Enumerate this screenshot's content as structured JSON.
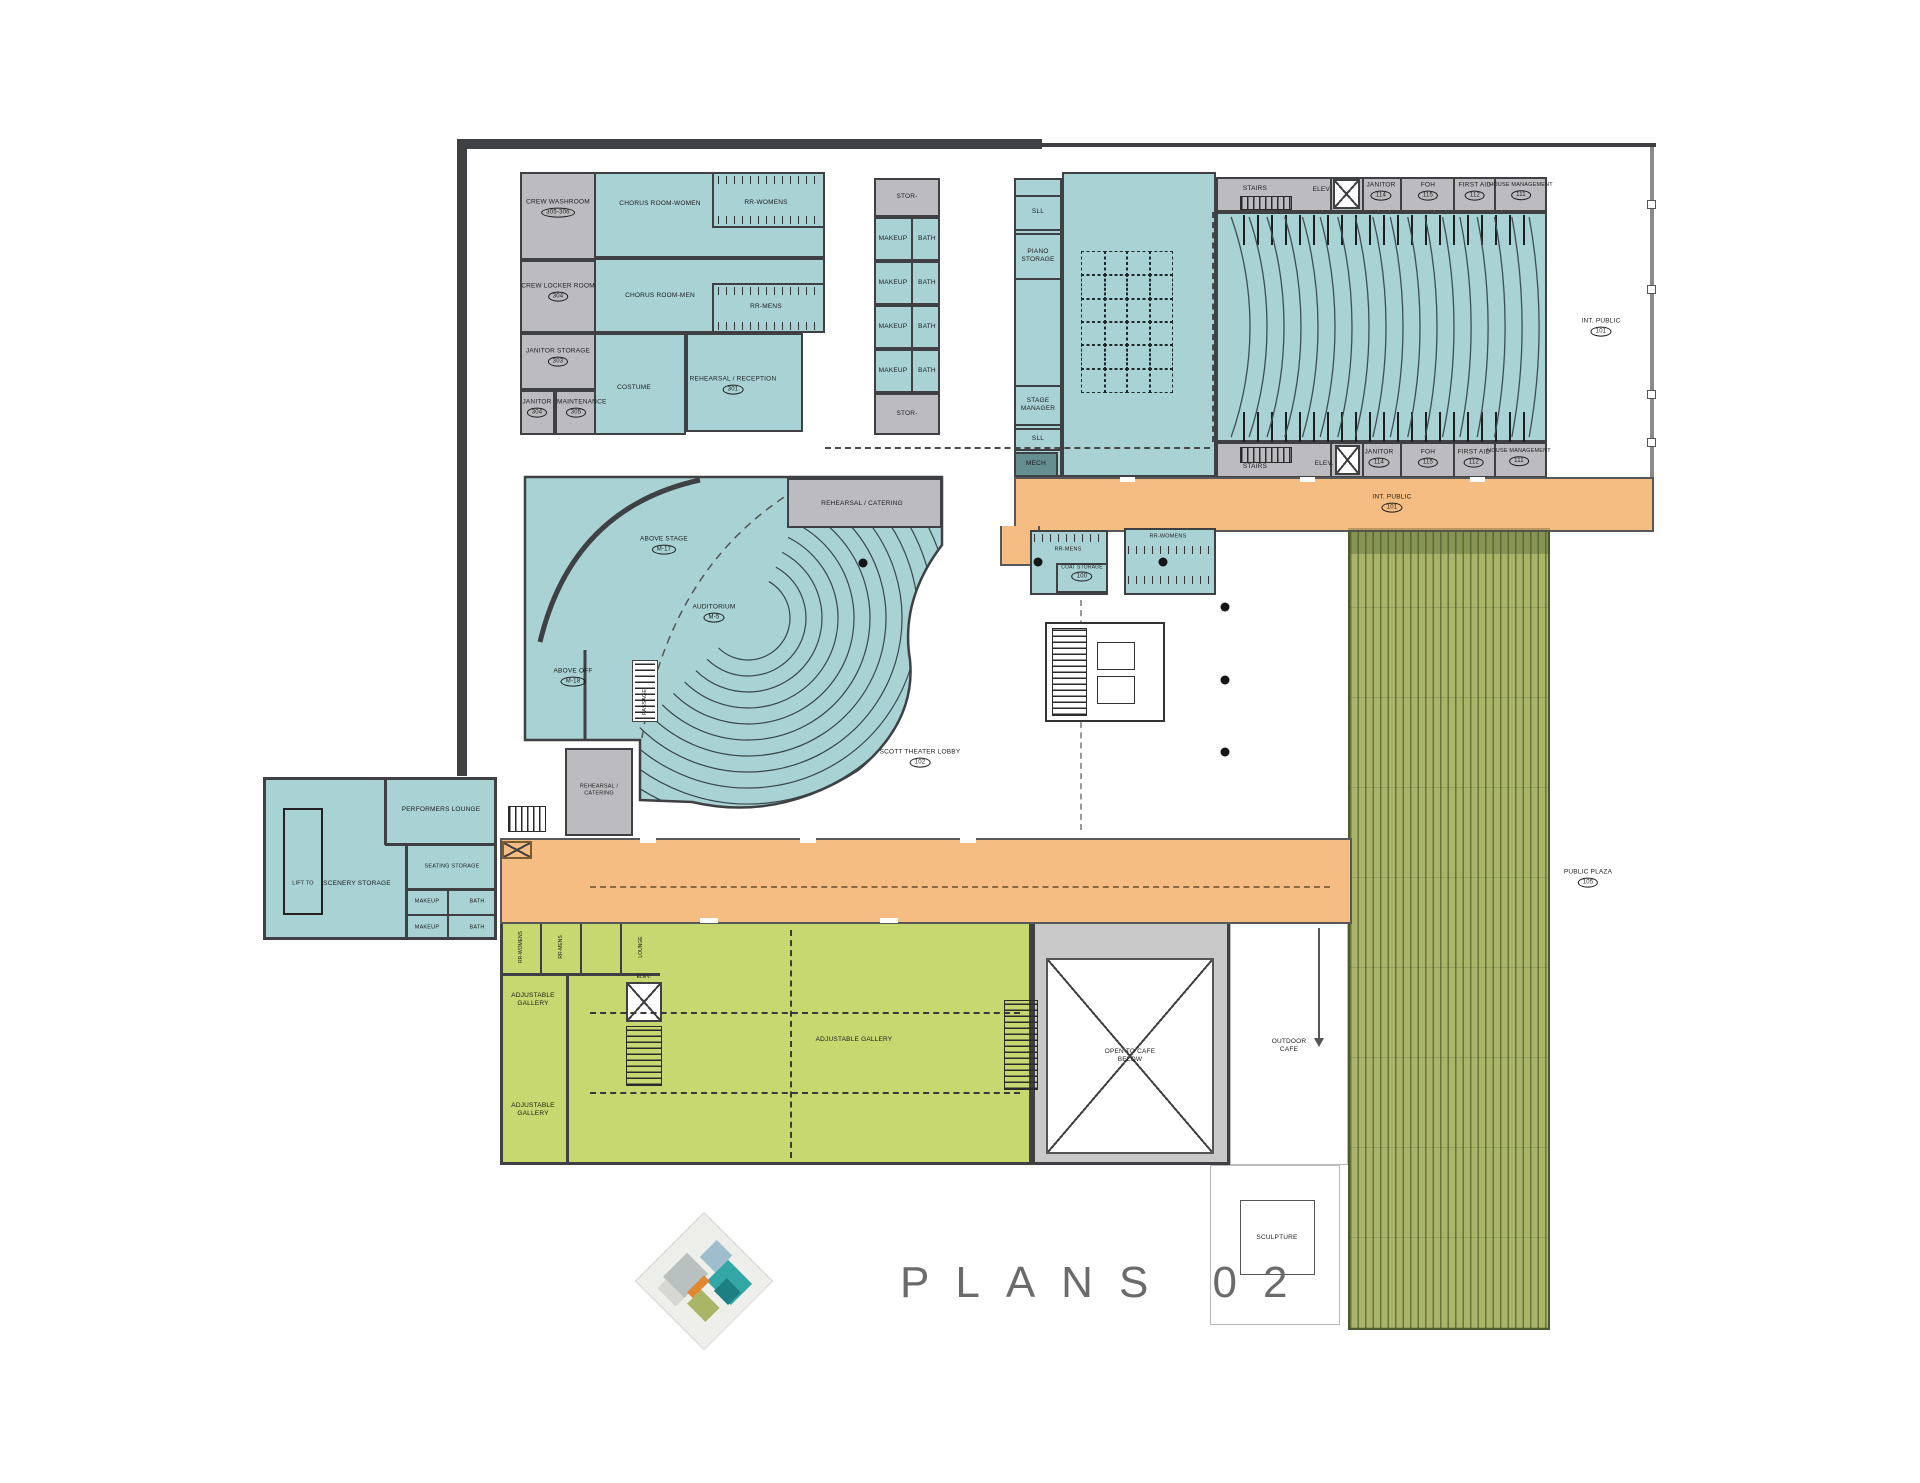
{
  "title": "PLANS 02",
  "colors": {
    "room_teal": "#a9d2d4",
    "room_gray": "#bcbcc0",
    "wall": "#3f4043",
    "terrace_orange": "#f6bd82",
    "gallery_green": "#c6d86f",
    "plaza_olive": "#abb56a"
  },
  "r": {
    "crew_washroom": "CREW WASHROOM",
    "crew_washroom_no": "305-306",
    "crew_locker": "CREW LOCKER ROOM",
    "crew_locker_no": "304",
    "janitor_storage": "JANITOR STORAGE",
    "janitor_storage_no": "303",
    "janitor": "JANITOR",
    "janitor_no": "304",
    "maintenance": "MAINTENANCE",
    "maintenance_no": "305",
    "chorus_women": "CHORUS ROOM-WOMEN",
    "rr_womens": "RR-WOMENS",
    "chorus_men": "CHORUS ROOM-MEN",
    "rr_mens": "RR-MENS",
    "costume": "COSTUME",
    "rehearsal_reception": "REHEARSAL / RECEPTION",
    "rehearsal_reception_no": "301",
    "stor": "STOR-",
    "makeup": "MAKEUP",
    "bath": "BATH",
    "sll": "SLL",
    "piano": "PIANO STORAGE",
    "stage_manager": "STAGE MANAGER",
    "mech": "MECH",
    "stairs": "STAIRS",
    "elev": "ELEV.",
    "janitor_th": "JANITOR",
    "janitor_th_no": "114",
    "foh": "FOH",
    "foh_no": "115",
    "first_aid": "FIRST AID",
    "first_aid_no": "112",
    "house_mgmt": "HOUSE MANAGEMENT",
    "house_mgmt_no": "111",
    "int_public": "INT. PUBLIC",
    "int_public_no": "101",
    "above_stage": "ABOVE STAGE",
    "above_stage_no": "M-17",
    "above_off": "ABOVE OFF",
    "above_off_no": "M-18",
    "auditorium": "AUDITORIUM",
    "auditorium_no": "M-5",
    "passage": "PASSAGE",
    "rehearsal_catering": "REHEARSAL / CATERING",
    "scott_lobby": "SCOTT THEATER LOBBY",
    "scott_lobby_no": "102",
    "coat": "COAT STORAGE",
    "coat_no": "100",
    "performers": "PERFORMERS LOUNGE",
    "lift": "LIFT TO",
    "scenery": "SCENERY STORAGE",
    "seating": "SEATING STORAGE",
    "adjustable": "ADJUSTABLE GALLERY",
    "lounge": "LOUNGE",
    "open_cafe": "OPEN TO CAFE BELOW",
    "outdoor_cafe": "OUTDOOR CAFE",
    "sculpture": "SCULPTURE",
    "plaza": "PUBLIC PLAZA",
    "plaza_no": "105"
  }
}
